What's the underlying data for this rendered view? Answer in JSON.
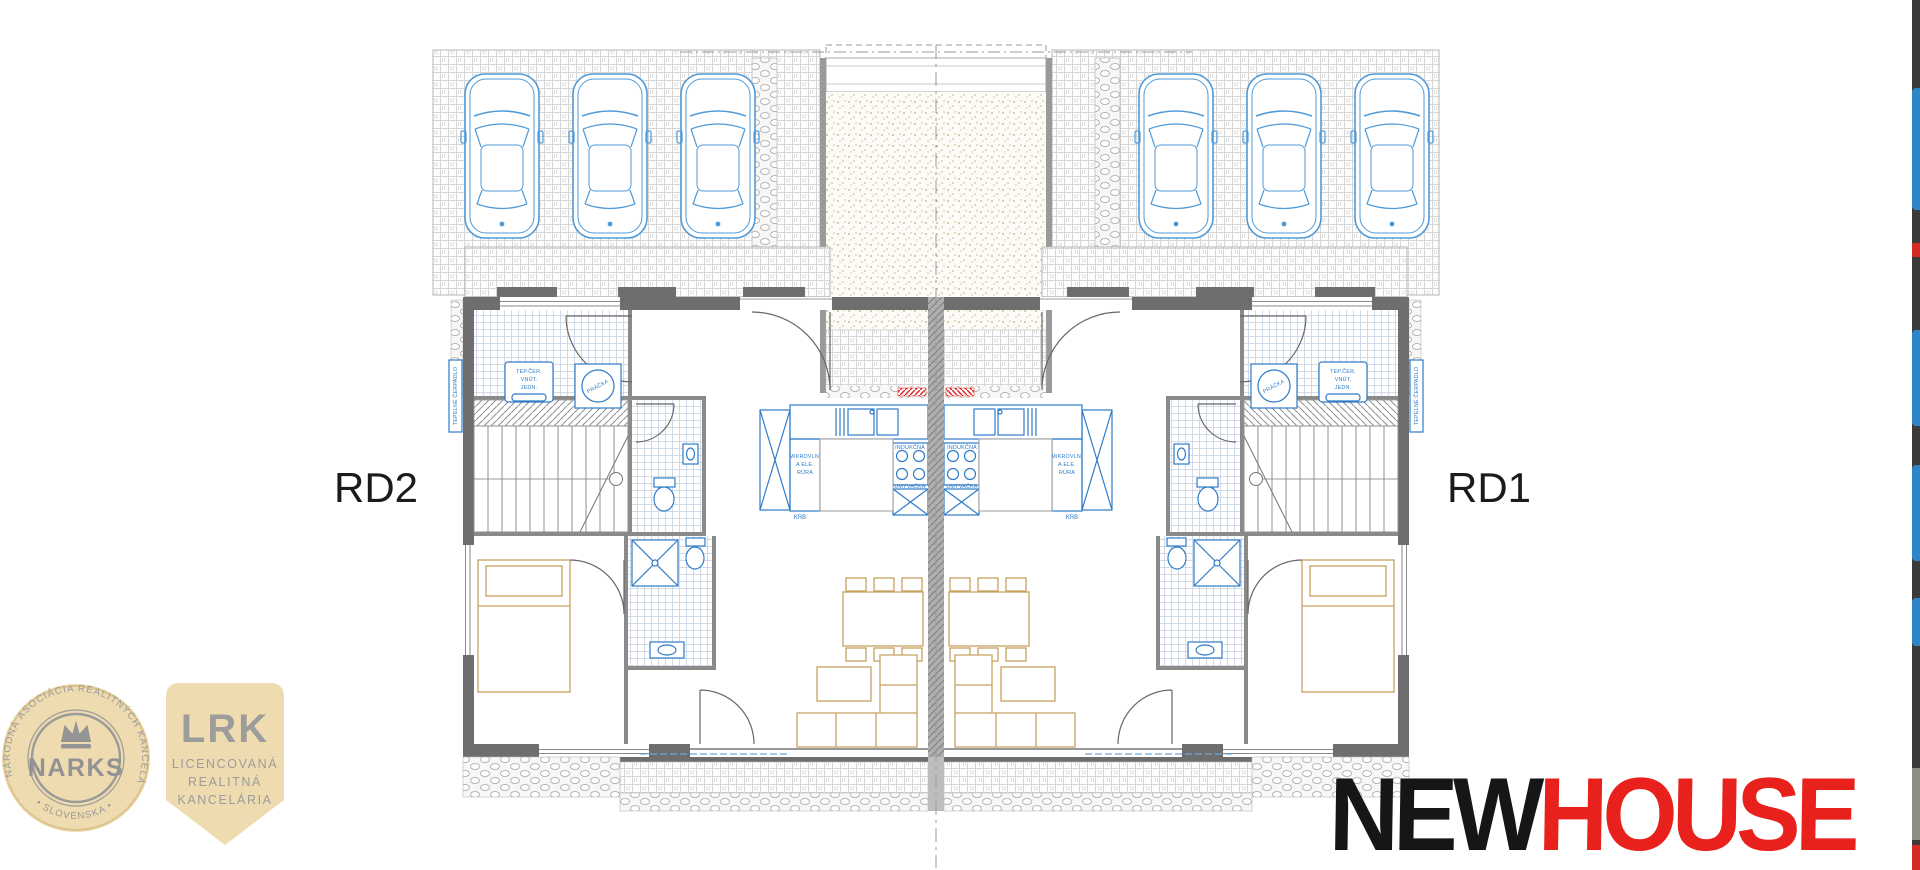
{
  "plan": {
    "unit_left_label": "RD2",
    "unit_right_label": "RD1",
    "kitchen": {
      "microwave_oven": [
        "MIKROVLN.",
        "A ELE.",
        "RÚRA"
      ],
      "induction_hob": "INDUKČNÁ",
      "dishwasher": "UMÝVAČKA",
      "fireplace": "KRB"
    },
    "tech_room": {
      "washing_machine": "PRÁČKA",
      "heat_pump_indoor": [
        "TEP.ČER.",
        "VNÚT.",
        "JEDN."
      ],
      "heat_pump_outdoor": "TEPELNÉ ČERPADLO"
    }
  },
  "badges": {
    "narks": {
      "ring_text_top": "NÁRODNÁ ASOCIÁCIA REALITNÝCH KANCELÁRIÍ",
      "ring_text_bottom": "• SLOVENSKA •",
      "name": "NARKS"
    },
    "lrk": {
      "abbr": "LRK",
      "lines": [
        "LICENCOVANÁ",
        "REALITNÁ",
        "KANCELÁRIA"
      ]
    }
  },
  "brand": {
    "word_black": "NEW",
    "word_red": "HOUSE"
  },
  "colors": {
    "drawing_blue": "#3d8bd4",
    "furniture_tan": "#c8a262",
    "wall_gray": "#6e6e6e",
    "badge_beige": "#eedcb0",
    "badge_gray": "#9a9a9a",
    "brand_black": "#161616",
    "brand_red": "#e8211d",
    "marker_red": "#e02420"
  }
}
